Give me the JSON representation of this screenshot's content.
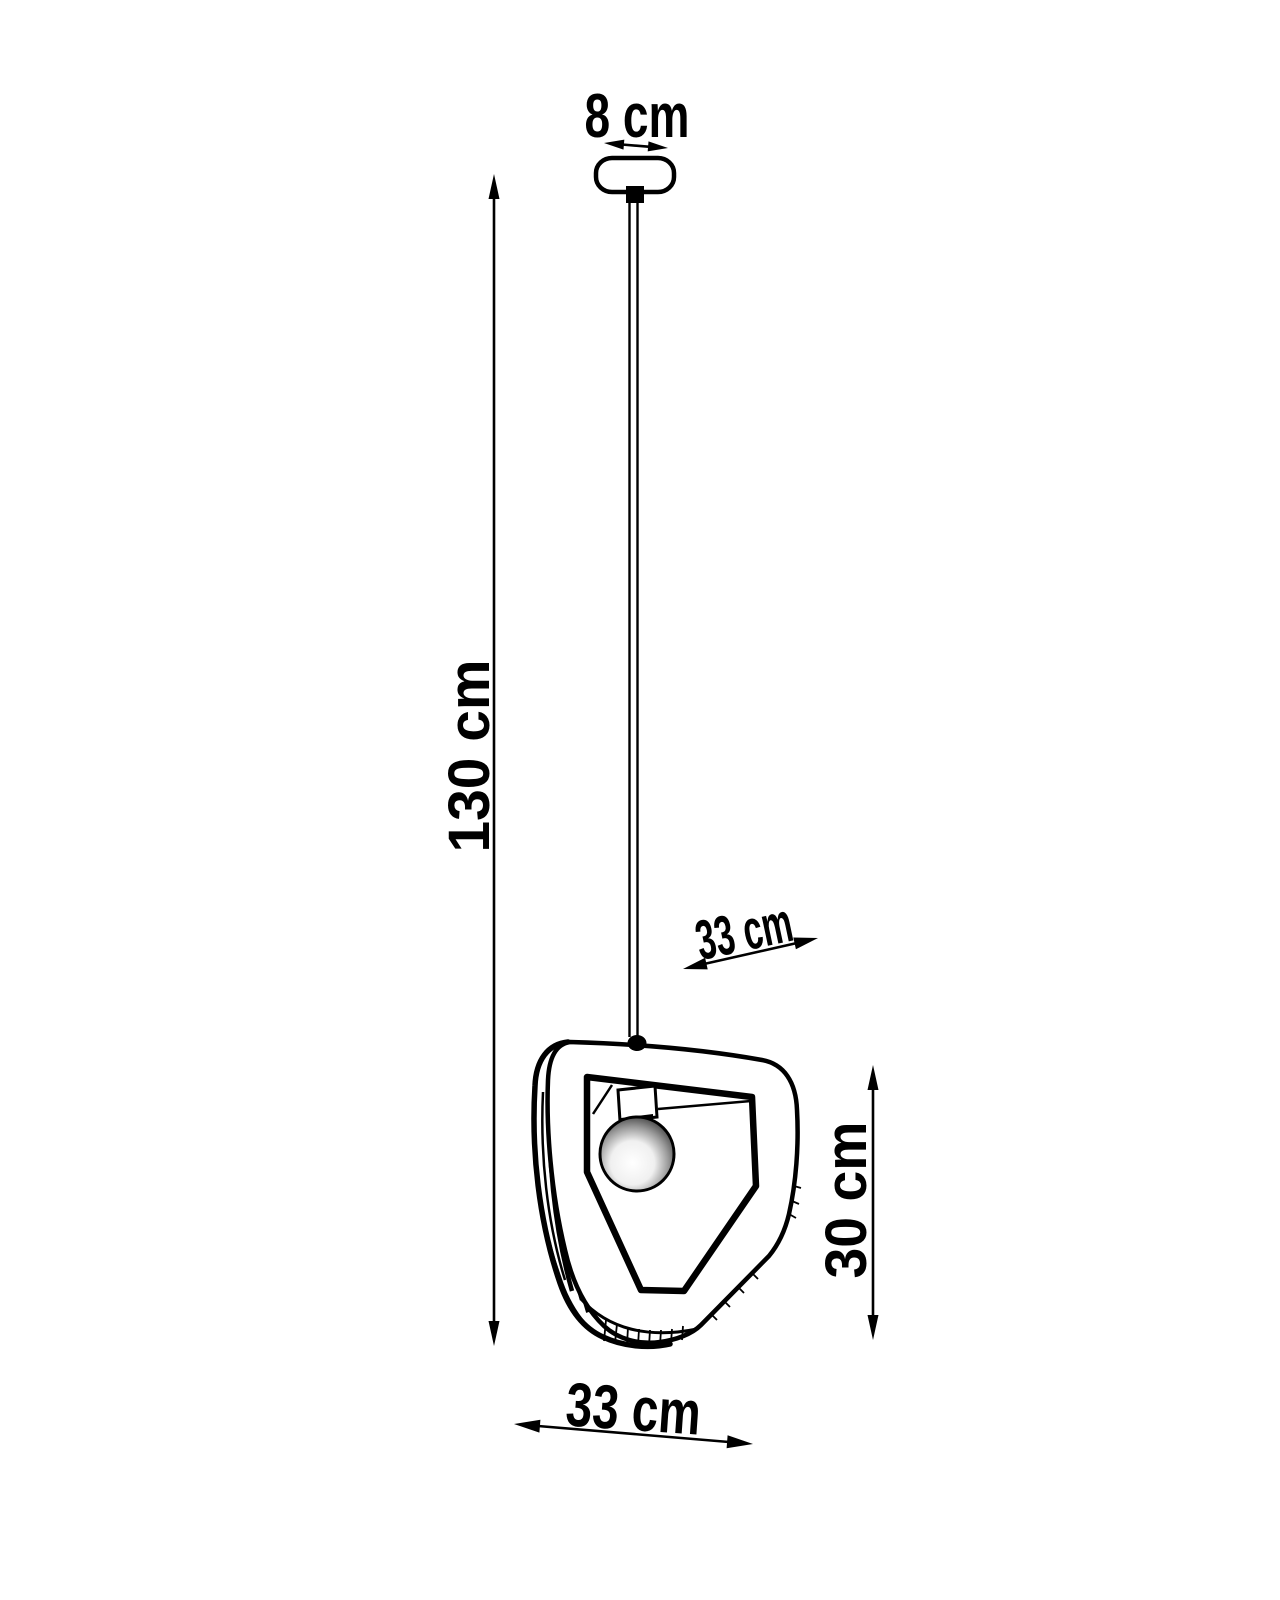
{
  "diagram": {
    "type": "product-dimension-drawing",
    "subject": "pendant lamp with triangular wooden shade and exposed bulb",
    "background_color": "#ffffff",
    "ink_color": "#000000",
    "labels": {
      "canopy_width": "8 cm",
      "cable_length": "130 cm",
      "shade_depth": "33 cm",
      "shade_height": "30 cm",
      "shade_width": "33 cm"
    }
  }
}
